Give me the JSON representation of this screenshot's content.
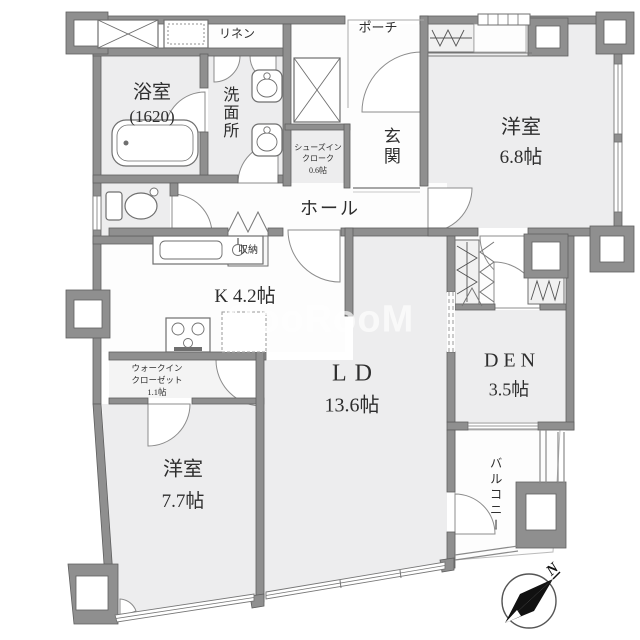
{
  "watermark": {
    "text": "GooRooM"
  },
  "compass": {
    "north_label": "N"
  },
  "rooms": {
    "bath": {
      "name": "浴室",
      "size": "(1620)"
    },
    "washroom": {
      "name": "洗面所"
    },
    "linen": {
      "name": "リネン"
    },
    "porch": {
      "name": "ポーチ"
    },
    "entrance": {
      "name": "玄関"
    },
    "shoes_in_cloak": {
      "line1": "シューズイン",
      "line2": "クローク",
      "line3": "0.6帖"
    },
    "hall": {
      "name": "ホール"
    },
    "storage": {
      "name": "収納"
    },
    "kitchen": {
      "name": "K 4.2帖"
    },
    "walk_in_closet": {
      "line1": "ウォークイン",
      "line2": "クローゼット",
      "line3": "1.1帖"
    },
    "bedroom1": {
      "name": "洋室",
      "size": "6.8帖"
    },
    "bedroom2": {
      "name": "洋室",
      "size": "7.7帖"
    },
    "living_dining": {
      "name": "LD",
      "size": "13.6帖"
    },
    "den": {
      "name": "DEN",
      "size": "3.5帖"
    },
    "balcony": {
      "name": "バルコニー"
    }
  },
  "colors": {
    "wall": "#8f8f8f",
    "room_fill": "#ededee",
    "white_fill": "#fdfdfd"
  }
}
